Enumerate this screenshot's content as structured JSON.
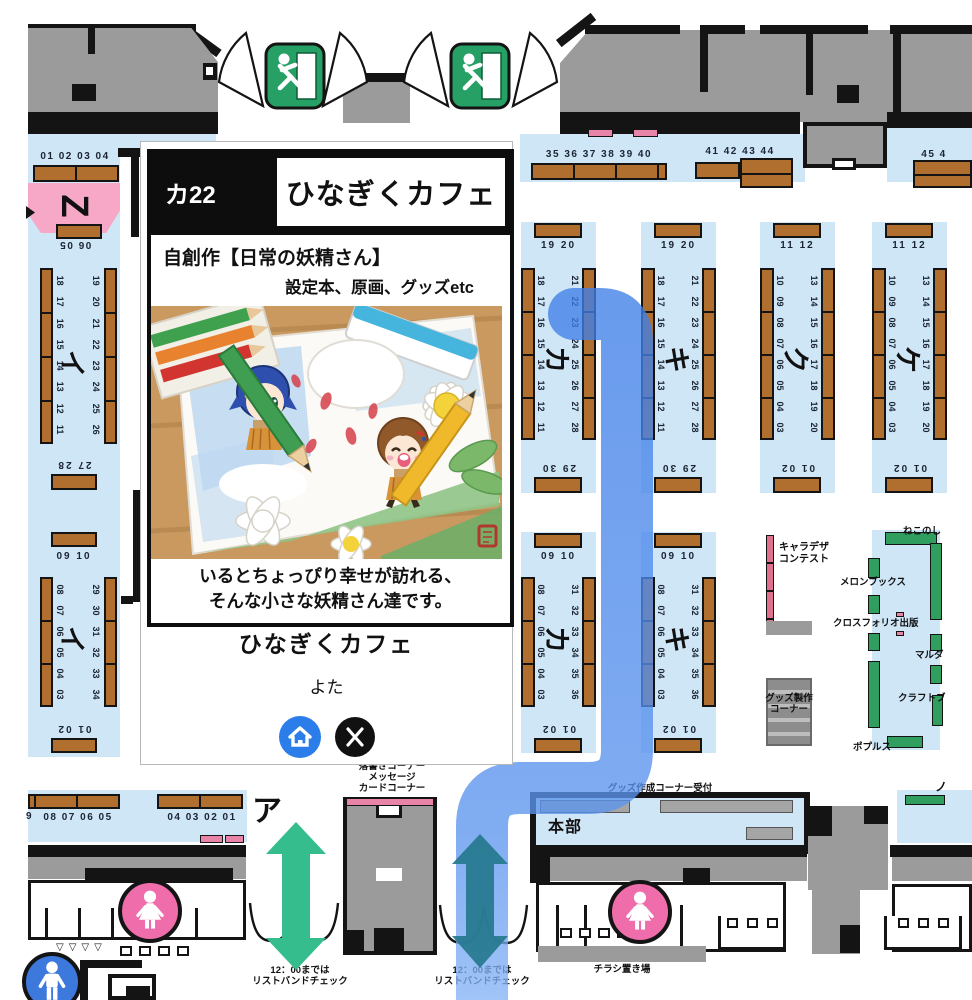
{
  "popup": {
    "booth_code": "カ22",
    "title": "ひなぎくカフェ",
    "genre": "自創作【日常の妖精さん】",
    "items": "設定本、原画、グッズetc",
    "caption": [
      "いるとちょっぴり幸せが訪れる、",
      "そんな小さな妖精さん達です。"
    ],
    "circle_name": "ひなぎくカフェ",
    "author": "よた",
    "link_icons": [
      "home-icon",
      "x-icon"
    ]
  },
  "left_area": {
    "z_label": "Z",
    "z_top_numbers": "01 02 03 04",
    "z_bottom_numbers": "06 05"
  },
  "columns": [
    {
      "id": "i1",
      "label": "イ",
      "top": "",
      "bottom": "27 28",
      "left": [
        "18",
        "17",
        "16",
        "15",
        "14",
        "13",
        "12",
        "11"
      ],
      "right": [
        "19",
        "20",
        "21",
        "22",
        "23",
        "24",
        "25",
        "26"
      ]
    },
    {
      "id": "i2",
      "label": "イ",
      "top": "09 10",
      "bottom": "01 02",
      "left": [
        "08",
        "07",
        "06",
        "05",
        "04",
        "03"
      ],
      "right": [
        "29",
        "30",
        "31",
        "32",
        "33",
        "34"
      ]
    },
    {
      "id": "ka_u",
      "label": "カ",
      "top": "19 20",
      "bottom": "29 30",
      "left": [
        "18",
        "17",
        "16",
        "15",
        "14",
        "13",
        "12",
        "11"
      ],
      "right": [
        "21",
        "22",
        "23",
        "24",
        "25",
        "26",
        "27",
        "28"
      ]
    },
    {
      "id": "ki_u",
      "label": "キ",
      "top": "19 20",
      "bottom": "29 30",
      "left": [
        "18",
        "17",
        "16",
        "15",
        "14",
        "13",
        "12",
        "11"
      ],
      "right": [
        "21",
        "22",
        "23",
        "24",
        "25",
        "26",
        "27",
        "28"
      ]
    },
    {
      "id": "ku",
      "label": "ク",
      "top": "11 12",
      "bottom": "01 02",
      "left": [
        "10",
        "09",
        "08",
        "07",
        "06",
        "05",
        "04",
        "03"
      ],
      "right": [
        "13",
        "14",
        "15",
        "16",
        "17",
        "18",
        "19",
        "20"
      ]
    },
    {
      "id": "ke",
      "label": "ケ",
      "top": "11 12",
      "bottom": "01 02",
      "left": [
        "10",
        "09",
        "08",
        "07",
        "06",
        "05",
        "04",
        "03"
      ],
      "right": [
        "13",
        "14",
        "15",
        "16",
        "17",
        "18",
        "19",
        "20"
      ]
    },
    {
      "id": "ka_l",
      "label": "カ",
      "top": "09 10",
      "bottom": "01 02",
      "left": [
        "08",
        "07",
        "06",
        "05",
        "04",
        "03"
      ],
      "right": [
        "31",
        "32",
        "33",
        "34",
        "35",
        "36"
      ]
    },
    {
      "id": "ki_l",
      "label": "キ",
      "top": "09 10",
      "bottom": "01 02",
      "left": [
        "08",
        "07",
        "06",
        "05",
        "04",
        "03"
      ],
      "right": [
        "31",
        "32",
        "33",
        "34",
        "35",
        "36"
      ]
    }
  ],
  "top_area": {
    "numbers_1": "35 36 37 38 39 40",
    "numbers_2": "41 42 43 44",
    "numbers_3": "45 4"
  },
  "right_area": {
    "charadesign": [
      "キャラデザ",
      "コンテスト"
    ],
    "vendors": [
      "ねこのし",
      "メロンブックス",
      "クロスフォリオ出版",
      "マルダ",
      "クラフトブ",
      "ポプルス"
    ],
    "goods_corner": [
      "グッズ製作",
      "コーナー"
    ]
  },
  "bottom_area": {
    "a_label": "ア",
    "a_partial": "9",
    "a_numbers_1": "08 07 06 05",
    "a_numbers_2": "04 03 02 01",
    "honbu": "本部",
    "goods_reception": "グッズ作成コーナー受付",
    "chirashi": "チラシ置き場",
    "rakugaki": [
      "落書きコーナー",
      "メッセージ",
      "カードコーナー"
    ],
    "wristband": [
      "12：00までは",
      "リストバンドチェック"
    ],
    "partial_no": "ノ"
  },
  "colors": {
    "aisle_blue": "#cfe6f7",
    "route_blue": "#4286f0",
    "table_brown": "#b06f2e",
    "vendor_green": "#2f9e5f",
    "zone_pink": "#f6a8c6",
    "women_pink": "#ef6daa",
    "men_blue": "#3d78dd",
    "arrow_green": "#35bd8d",
    "arrow_teal": "#26798f",
    "exit_green": "#26a065"
  }
}
